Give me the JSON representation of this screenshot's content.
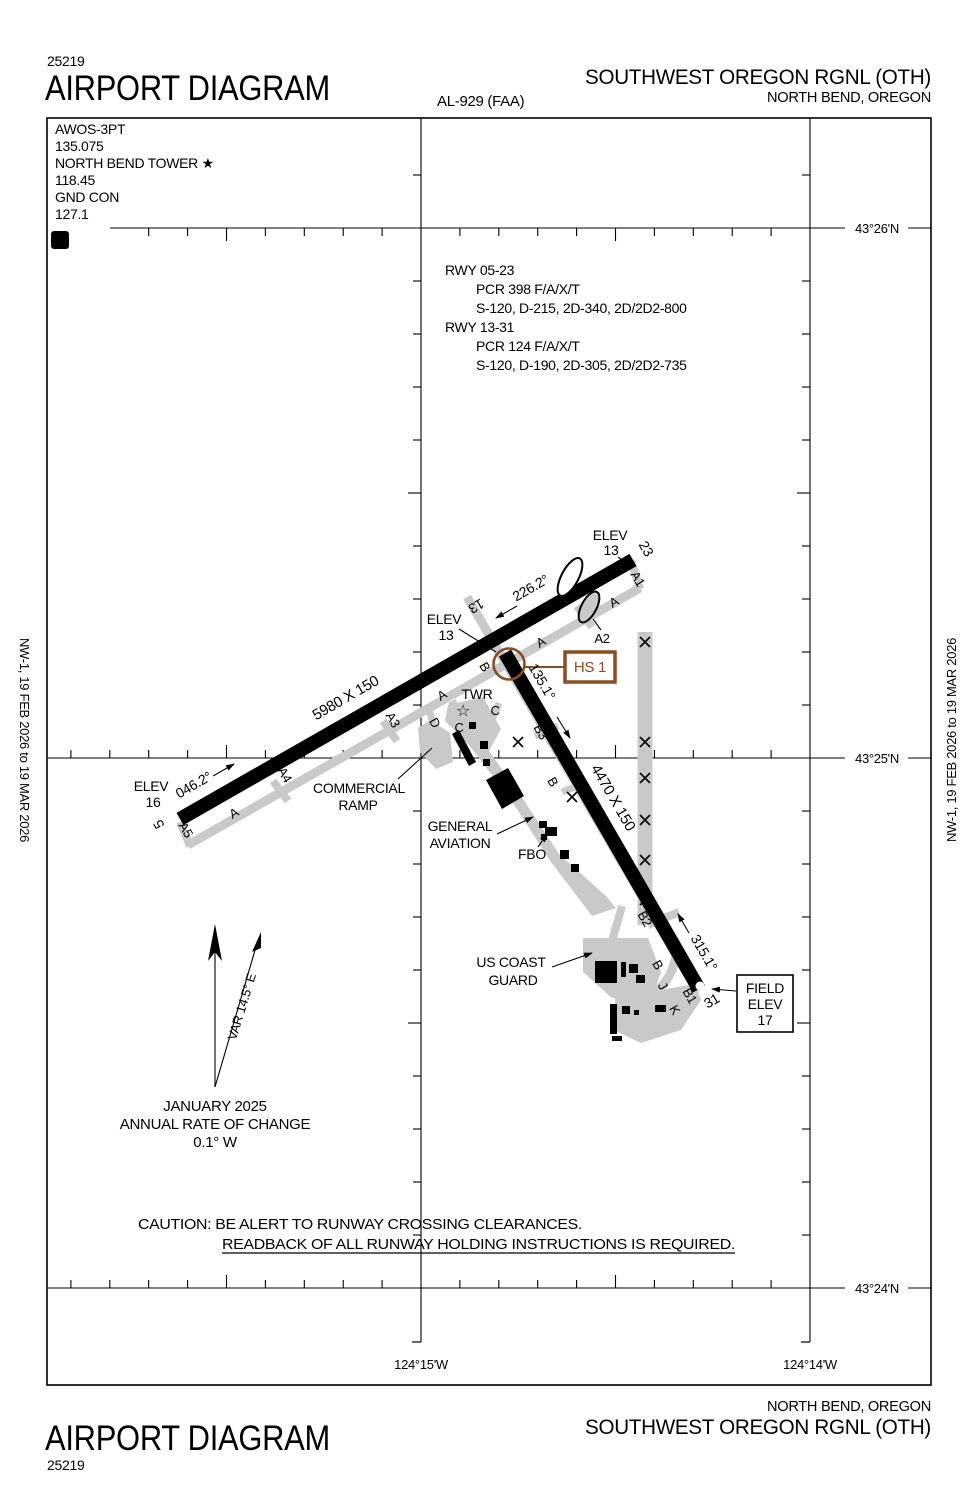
{
  "header": {
    "chart_code": "25219",
    "title": "AIRPORT DIAGRAM",
    "al_number": "AL-929 (FAA)",
    "airport": "SOUTHWEST OREGON RGNL (OTH)",
    "city": "NORTH BEND, OREGON"
  },
  "comm": {
    "lines": [
      "AWOS-3PT",
      "135.075",
      "NORTH BEND TOWER ★",
      "118.45",
      "GND CON",
      "127.1"
    ],
    "hotspot_badge": "D"
  },
  "rwy_info": {
    "lines": [
      "RWY 05-23",
      "PCR 398 F/A/X/T",
      "S-120, D-215, 2D-340, 2D/2D2-800",
      "RWY 13-31",
      "PCR 124 F/A/X/T",
      "S-120, D-190, 2D-305, 2D/2D2-735"
    ]
  },
  "graticule": {
    "lat": [
      "43°26'N",
      "43°25'N",
      "43°24'N"
    ],
    "lon": [
      "124°15'W",
      "124°14'W"
    ]
  },
  "runways": {
    "r0523": {
      "num_5": "5",
      "num_23": "23",
      "dim": "5980 X 150",
      "hdg_ne": "046.2°",
      "hdg_sw": "226.2°"
    },
    "r1331": {
      "num_13": "13",
      "num_31": "31",
      "dim": "4470 X 150",
      "hdg_se": "135.1°",
      "hdg_nw": "315.1°"
    },
    "elev_5": {
      "l1": "ELEV",
      "l2": "16"
    },
    "elev_13": {
      "l1": "ELEV",
      "l2": "13"
    },
    "elev_23": {
      "l1": "ELEV",
      "l2": "13"
    },
    "field_elev": {
      "l1": "FIELD",
      "l2": "ELEV",
      "l3": "17"
    }
  },
  "hotspot": {
    "label": "HS 1"
  },
  "facilities": {
    "twr": "TWR",
    "commercial_ramp_1": "COMMERCIAL",
    "commercial_ramp_2": "RAMP",
    "general_aviation_1": "GENERAL",
    "general_aviation_2": "AVIATION",
    "fbo": "FBO",
    "uscg_1": "US COAST",
    "uscg_2": "GUARD"
  },
  "taxiways": {
    "a": "A",
    "a1": "A1",
    "a2": "A2",
    "a3": "A3",
    "a4": "A4",
    "a5": "A5",
    "b": "B",
    "b1": "B1",
    "b2": "B2",
    "b3": "B3",
    "c": "C",
    "d": "D",
    "j": "J",
    "k": "K"
  },
  "compass": {
    "variation": "VAR 14.5° E",
    "date": "JANUARY 2025",
    "rate_label": "ANNUAL RATE OF CHANGE",
    "rate_value": "0.1° W"
  },
  "caution": {
    "line1": "CAUTION: BE ALERT TO RUNWAY CROSSING CLEARANCES.",
    "line2": "READBACK OF ALL RUNWAY HOLDING INSTRUCTIONS IS REQUIRED."
  },
  "footer": {
    "city": "NORTH BEND, OREGON",
    "airport": "SOUTHWEST OREGON RGNL (OTH)",
    "title": "AIRPORT DIAGRAM",
    "chart_code": "25219"
  },
  "edge": {
    "left": "NW-1,  19 FEB 2026  to  19 MAR 2026",
    "right": "NW-1,  19 FEB 2026  to  19 MAR 2026"
  },
  "colors": {
    "hotspot_brown": "#8B4D21",
    "taxiway_gray": "#C9C9C9"
  }
}
